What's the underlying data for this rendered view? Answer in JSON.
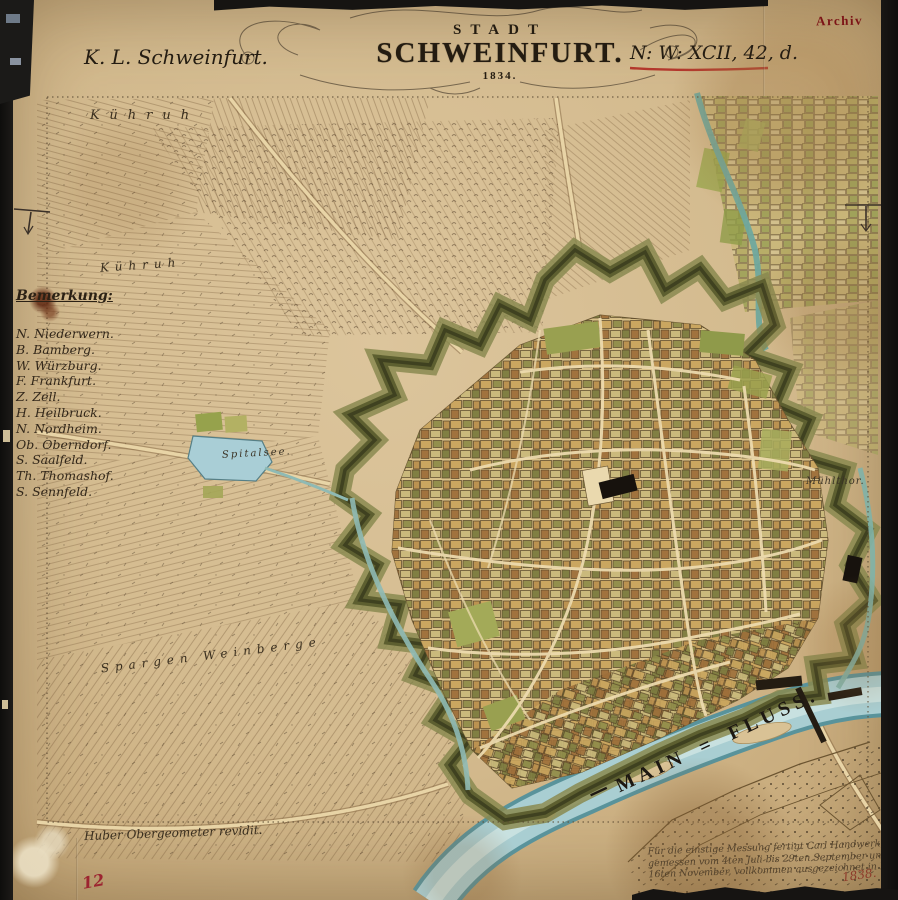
{
  "stamp": {
    "archiv": "Archiv"
  },
  "header": {
    "left_ref": "K. L. Schweinfurt.",
    "right_ref": "N: W: XCII, 42, d.",
    "title_small": "STADT",
    "title_large": "SCHWEINFURT.",
    "title_year": "1834."
  },
  "legend": {
    "title": "Bemerkung:",
    "items": [
      "N. Niederwern.",
      "B. Bamberg.",
      "W. Würzburg.",
      "F. Frankfurt.",
      "Z. Zell.",
      "H. Heilbruck.",
      "N. Nordheim.",
      "Ob. Oberndorf.",
      "S. Saalfeld.",
      "Th. Thomashof.",
      "S. Sennfeld."
    ]
  },
  "map_labels": {
    "kuehruh_top": "Kühruh",
    "kuehruh_mid": "Kühruh",
    "spitalsee": "Spitalsee.",
    "muehlthor": "Mühlthor.",
    "spargen_weinberge": "Spargen Weinberge",
    "main_fluss": "MAIN = FLUSS.",
    "main_fluss_dash": "—"
  },
  "footer": {
    "revision_note": "Huber Obergeometer revidit.",
    "inscription_lines": [
      "Für die einstige Messung fertigt Carl Handwerk,",
      "gemessen vom 4ten Juli bis 29ten September und vom 6ten bis",
      "16ten November, vollkommen ausgezeichnet in München."
    ],
    "inscription_year": "1838.",
    "sheet_number": "12"
  },
  "colors": {
    "paper": "#d4bb8f",
    "ink": "#2b2115",
    "red_stamp": "#7c1316",
    "red_mark": "#a02430",
    "river": "#a9ced2",
    "fort_dark": "#3f4120",
    "fort_light": "#8a8a50",
    "lake": "#a9ced6"
  }
}
